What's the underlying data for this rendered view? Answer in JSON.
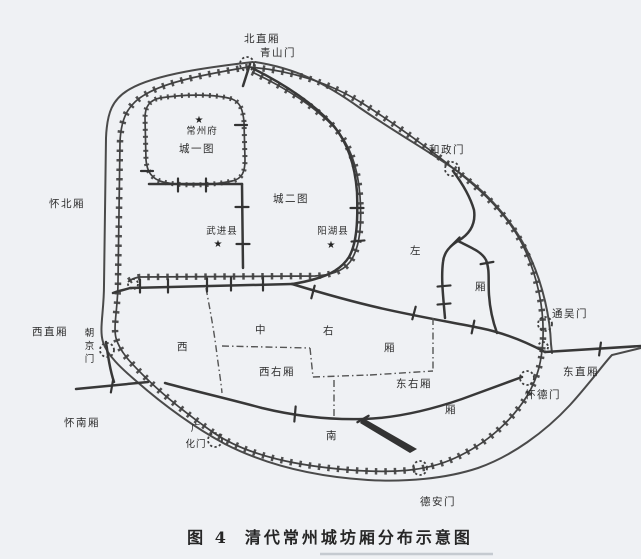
{
  "figure": {
    "caption_prefix": "图 4",
    "caption_title": "清代常州城坊厢分布示意图"
  },
  "symbols": {
    "star": "★"
  },
  "landmarks": {
    "prefecture": "常州府",
    "wujin_county": "武进县",
    "yanghu_county": "阳湖县"
  },
  "wards": {
    "bei_zhi": "北直厢",
    "huai_bei": "怀北厢",
    "xi_zhi": "西直厢",
    "huai_nan": "怀南厢",
    "dong_zhi": "东直厢",
    "cheng_yi_tu": "城一图",
    "cheng_er_tu": "城二图",
    "xi_you": "西右厢",
    "dong_you": "东右厢",
    "zuo": "左",
    "zuo_xiang": "厢",
    "xi": "西",
    "zhong": "中",
    "you": "右",
    "zhong_xiang": "厢",
    "nan": "南",
    "nan_xiang": "厢"
  },
  "gates": {
    "qingshan": "青山门",
    "hezheng": "和政门",
    "tongwu": "通吴门",
    "huaide": "怀德门",
    "dean": "德安门",
    "guanghua_line1": "广",
    "guanghua_line2": "化门",
    "chaojing": "朝京门"
  }
}
